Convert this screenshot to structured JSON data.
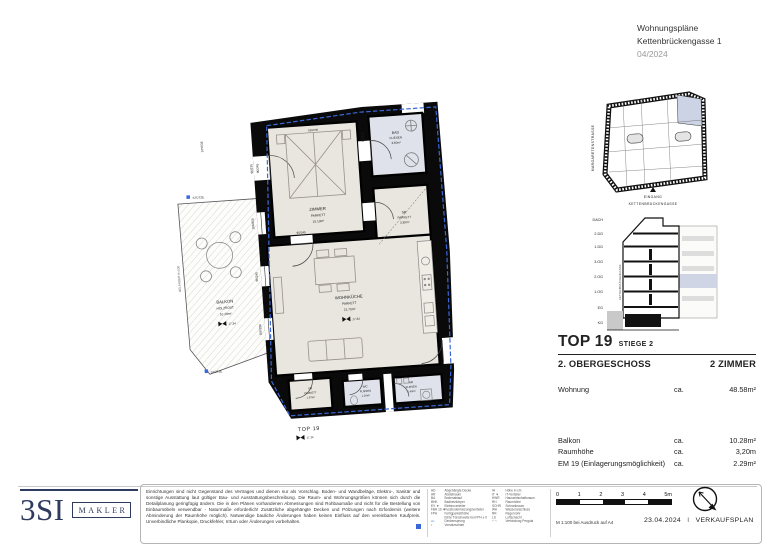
{
  "header": {
    "title": "Wohnungspläne",
    "address": "Kettenbrückengasse 1",
    "date": "04/2024"
  },
  "floor_plan": {
    "rooms": [
      {
        "name": "ZIMMER",
        "finish": "PARKETT",
        "area": "15.13m²"
      },
      {
        "name": "BAD",
        "finish": "FLIESEN",
        "area": "3.60m²"
      },
      {
        "name": "SR",
        "finish": "PARKETT",
        "area": "3.39m²"
      },
      {
        "name": "WOHNKÜCHE",
        "finish": "PARKETT",
        "area": "21.70m²"
      },
      {
        "name": "VR",
        "finish": "PARKETT",
        "area": "1.97m²"
      },
      {
        "name": "WC",
        "finish": "FLIESEN",
        "area": "1.26m²"
      },
      {
        "name": "AR",
        "finish": "FLIESEN",
        "area": "1.40m²"
      },
      {
        "name": "BALKON",
        "finish": "HOLZROST",
        "area": "10.28m²"
      }
    ],
    "unit_label": "TOP 19",
    "level": "17.34",
    "stair_label": "STIEGE",
    "railing_label": "GELÄNDER H=100",
    "column_label": "STÜTZE",
    "bed_dim": "180/200",
    "dims": [
      "90/245",
      "100/250",
      "90/235",
      "80/230"
    ]
  },
  "site_plan": {
    "street_left": "MARGARETENSTRASSE",
    "entrance": "EINGANG",
    "street_bottom": "KETTENBRÜCKENGASSE"
  },
  "section": {
    "floors": [
      "DACH",
      "2.DG",
      "1.DG",
      "3.OG",
      "2.OG",
      "1.OG",
      "EG",
      "KG"
    ],
    "street": "KETTENBRÜCKENGASSE"
  },
  "unit_info": {
    "top": "TOP 19",
    "stiege": "STIEGE 2",
    "floor": "2. OBERGESCHOSS",
    "rooms": "2 ZIMMER",
    "rows": [
      {
        "label": "Wohnung",
        "ca": "ca.",
        "value": "48.58m²"
      },
      {
        "label": "Balkon",
        "ca": "ca.",
        "value": "10.28m²"
      },
      {
        "label": "Raumhöhe",
        "ca": "ca.",
        "value": "3,20m"
      },
      {
        "label": "EM 19 (Einlagerungsmöglichkeit)",
        "ca": "ca.",
        "value": "2.29m²"
      }
    ]
  },
  "footer": {
    "logo": {
      "brand": "3SI",
      "tag": "MAKLER"
    },
    "disclaimer": "Einrichtungen sind nicht Gegenstand des Vertrages und dienen nur als Vorschlag. Boden- und Wandbeläge, Elektro-, Sanitär und sonstige Ausstattung laut gültiger Bau- und Ausstattungsbeschreibung. Die Raum- und Wohnungsgrößen können sich durch die Detailplanung geringfügig ändern. Die in den Plänen vorhandenen Abmessungen sind Rohbaumaße und nicht für die Bestellung von Einbaumöbeln verwendbar - Naturmaße erforderlich! Zusätzliche abgehängte Decken und Pölzungen nach Erfordernis (weitere Abminderung der Raumhöhe möglich). Notwendige bauliche Änderungen haben keinen Einfluss auf den vereinbarten Kaufpreis. Unverbindliche Plankopie, Druckfehler, Irrtum oder Änderungen vorbehalten.",
    "legend_left": [
      [
        "AD",
        "Abgehängte Decke"
      ],
      [
        "AR",
        "Abstellraum"
      ],
      [
        "BA",
        "Bodenablauf"
      ],
      [
        "BHK",
        "Badheizkörper"
      ],
      [
        "EV ▼",
        "Elektroverteiler"
      ],
      [
        "FBH 19 ▼",
        "Fussbodenheizungsverteiler"
      ],
      [
        "FPH",
        "Fertigparketthöhe"
      ],
      [
        "",
        "lichte Türschwelle bei FPH ± 0"
      ],
      [
        "▪▪▪",
        "Deckensprung"
      ],
      [
        "▪",
        "Vorsatzschale"
      ]
    ],
    "legend_right": [
      [
        "IH",
        "Höhe in cm"
      ],
      [
        "IT ▼",
        "IT-Verteiler"
      ],
      [
        "HWR",
        "Hauswirtschaftsraum"
      ],
      [
        "RH",
        "Raumhöhe"
      ],
      [
        "SCHR",
        "Schrankraum"
      ],
      [
        "WA",
        "Wasseranschluss"
      ],
      [
        "RR",
        "Regenrohr"
      ],
      [
        "LS",
        "Luftschacht"
      ],
      [
        "⌐ ¬",
        "Verbindung Pergola"
      ]
    ],
    "scale": {
      "ticks": [
        "0",
        "1",
        "2",
        "3",
        "4",
        "5m"
      ],
      "note": "M 1:100 bei Ausdruck auf A4"
    },
    "date": "23.04.2024",
    "sep": "I",
    "doc_type": "VERKAUFSPLAN"
  },
  "colors": {
    "accent_dash": "#3b68d8",
    "highlight": "#ccd3e4",
    "brand_navy": "#2e3b5e",
    "room_beige": "#e9e6df",
    "room_tile": "#dfe2eb"
  }
}
